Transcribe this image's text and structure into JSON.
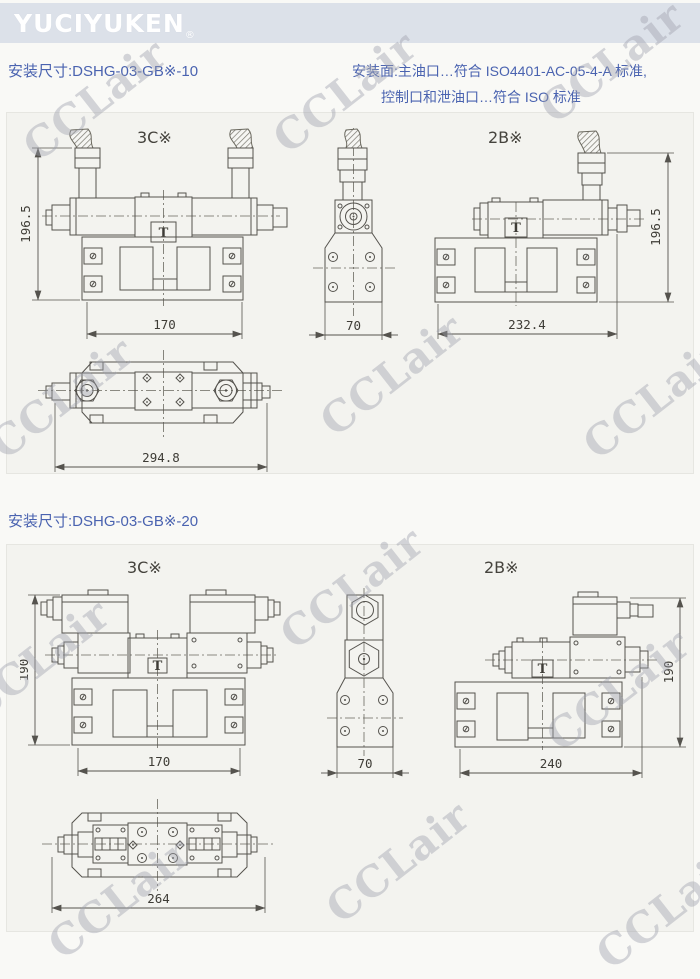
{
  "header": {
    "logo_text": "YUCIYUKEN",
    "registered_mark": "®"
  },
  "note": {
    "line1": "安装面:主油口…符合 ISO4401-AC-05-4-A 标准,",
    "line2": "控制口和泄油口…符合 ISO 标准"
  },
  "sections": [
    {
      "title": "安装尺寸:DSHG-03-GB※-10",
      "label_3c": "3C※",
      "label_2b": "2B※",
      "dims": {
        "height_3c": "196.5",
        "width_3c": "170",
        "side_width": "70",
        "height_2b": "196.5",
        "width_2b": "232.4",
        "plan_length": "294.8"
      }
    },
    {
      "title": "安装尺寸:DSHG-03-GB※-20",
      "label_3c": "3C※",
      "label_2b": "2B※",
      "dims": {
        "height_3c": "190",
        "width_3c": "170",
        "side_width": "70",
        "height_2b": "190",
        "width_2b": "240",
        "plan_length": "264"
      }
    }
  ],
  "symbols": {
    "drain": "T"
  },
  "watermark": {
    "text": "CCLair"
  },
  "colors": {
    "accent_blue": "#4a63b0",
    "header_band": "#dce1e9",
    "drawing_line": "#55534e",
    "watermark": "#b7b9c2"
  }
}
